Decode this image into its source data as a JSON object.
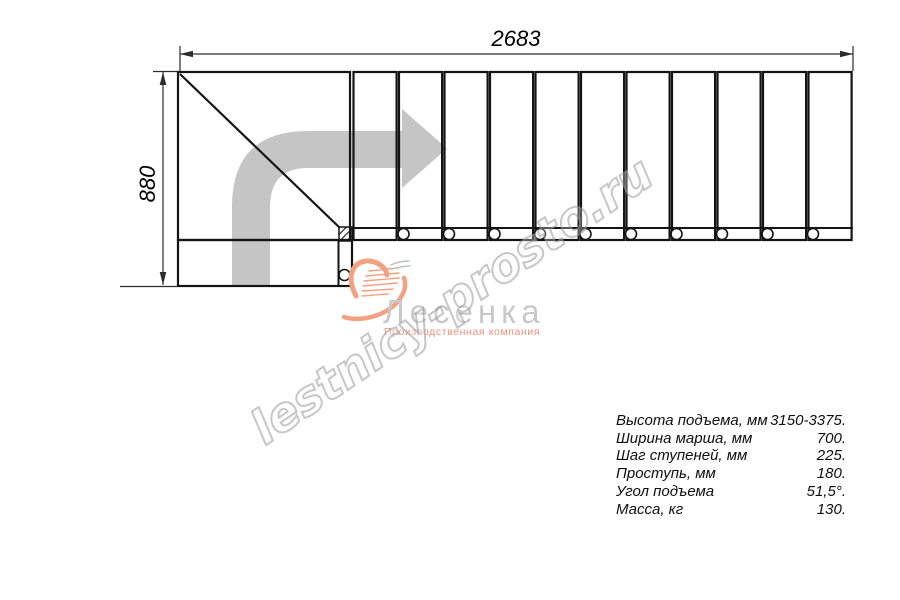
{
  "dimensions": {
    "width": "2683",
    "height": "880"
  },
  "drawing": {
    "treads": 11,
    "balusters": 10,
    "line_color": "#141414",
    "arrow_color": "#c5c5c5"
  },
  "watermark": {
    "text": "lestnicy-prosto.ru"
  },
  "logo": {
    "brand": "Лесенка",
    "tagline": "Производственная компания",
    "accent": "#f2a183",
    "text_color": "#c9c9c9"
  },
  "specs": {
    "rows": [
      {
        "label": "Высота подъема, мм",
        "value": "3150-3375."
      },
      {
        "label": "Ширина марша, мм",
        "value": "700."
      },
      {
        "label": "Шаг ступеней, мм",
        "value": "225."
      },
      {
        "label": "Проступь, мм",
        "value": "180."
      },
      {
        "label": "Угол подъема",
        "value": "51,5°."
      },
      {
        "label": "Масса, кг",
        "value": "130."
      }
    ]
  }
}
